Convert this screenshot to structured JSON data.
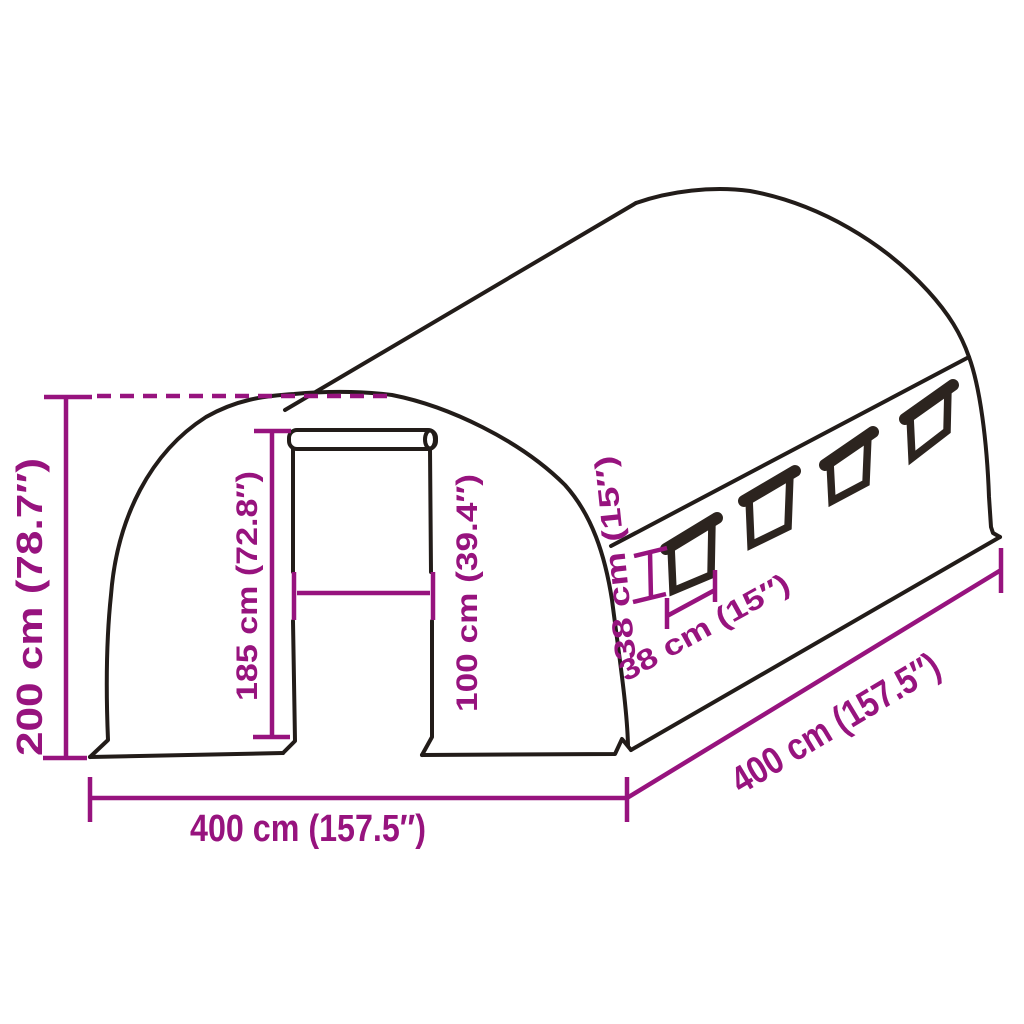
{
  "diagram": {
    "title": "Tunnel greenhouse dimension diagram",
    "product": "arched tunnel greenhouse with roll-up front door and side windows",
    "window_count": 4,
    "colors": {
      "dimension_accent": "#97137e",
      "outline": "#221c19",
      "window_frame": "#2c241f",
      "background": "#ffffff"
    },
    "labels": {
      "overall_height": "200 cm (78.7″)",
      "door_height": "185 cm (72.8″)",
      "door_width": "100 cm (39.4″)",
      "window_height": "38 cm (15″)",
      "window_width": "38 cm (15″)",
      "overall_width": "400 cm (157.5″)",
      "overall_depth": "400 cm (157.5″)"
    }
  }
}
